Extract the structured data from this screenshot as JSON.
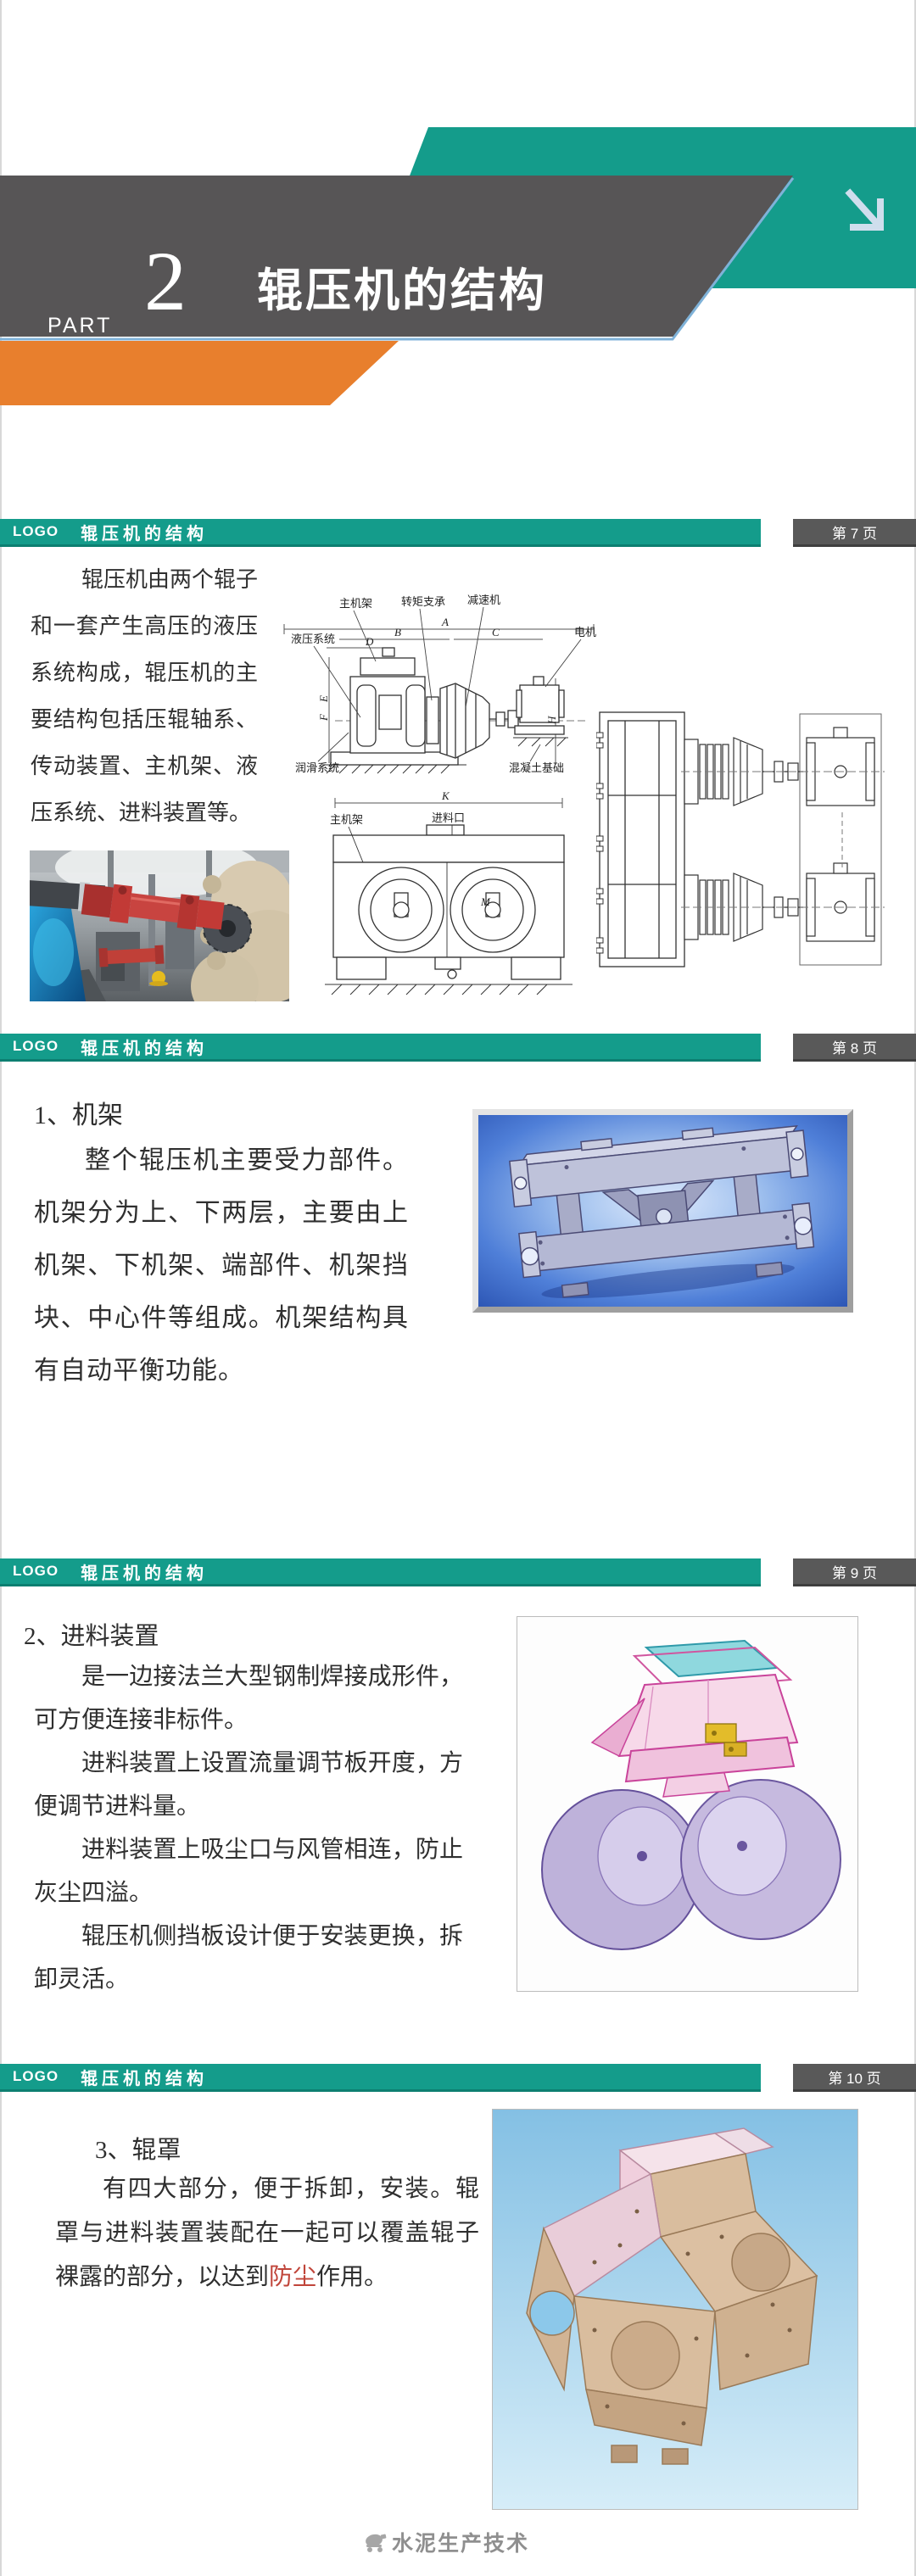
{
  "header": {
    "part_label": "PART",
    "part_number": "2",
    "title": "辊压机的结构"
  },
  "colors": {
    "teal": "#149c8b",
    "band_gray": "#575556",
    "orange": "#e87f2d",
    "pagebox_gray": "#595959",
    "highlight_red": "#c0453a"
  },
  "slides": [
    {
      "logo": "LOGO",
      "bar_title": "辊压机的结构",
      "page_label": "第 7 页",
      "body": "辊压机由两个辊子和一套产生高压的液压系统构成，辊压机的主要结构包括压辊轴系、传动装置、主机架、液压系统、进料装置等。",
      "diagram_side": {
        "labels": {
          "main_frame": "主机架",
          "torque_support": "转矩支承",
          "reducer": "减速机",
          "motor": "电机",
          "hydraulic": "液压系统",
          "lubrication": "润滑系统",
          "foundation": "混凝土基础"
        },
        "dims": {
          "a": "A",
          "b": "B",
          "c": "C",
          "d": "D",
          "e": "E",
          "f": "F",
          "h": "H"
        }
      },
      "diagram_front": {
        "labels": {
          "main_frame": "主机架",
          "feed_inlet": "进料口"
        },
        "dims": {
          "k": "K",
          "m": "M"
        }
      }
    },
    {
      "logo": "LOGO",
      "bar_title": "辊压机的结构",
      "page_label": "第 8 页",
      "heading": "1、机架",
      "body": "整个辊压机主要受力部件。机架分为上、下两层，主要由上机架、下机架、端部件、机架挡块、中心件等组成。机架结构具有自动平衡功能。"
    },
    {
      "logo": "LOGO",
      "bar_title": "辊压机的结构",
      "page_label": "第 9 页",
      "heading": "2、进料装置",
      "paragraphs": [
        "是一边接法兰大型钢制焊接成形件，可方便连接非标件。",
        "进料装置上设置流量调节板开度，方便调节进料量。",
        "进料装置上吸尘口与风管相连，防止灰尘四溢。",
        "辊压机侧挡板设计便于安装更换，拆卸灵活。"
      ]
    },
    {
      "logo": "LOGO",
      "bar_title": "辊压机的结构",
      "page_label": "第 10 页",
      "heading": "3、辊罩",
      "body_pre": "有四大部分，便于拆卸，安装。辊罩与进料装置装配在一起可以覆盖辊子裸露的部分，以达到",
      "body_highlight": "防尘",
      "body_post": "作用。"
    }
  ],
  "footer": {
    "watermark": "水泥生产技术"
  }
}
